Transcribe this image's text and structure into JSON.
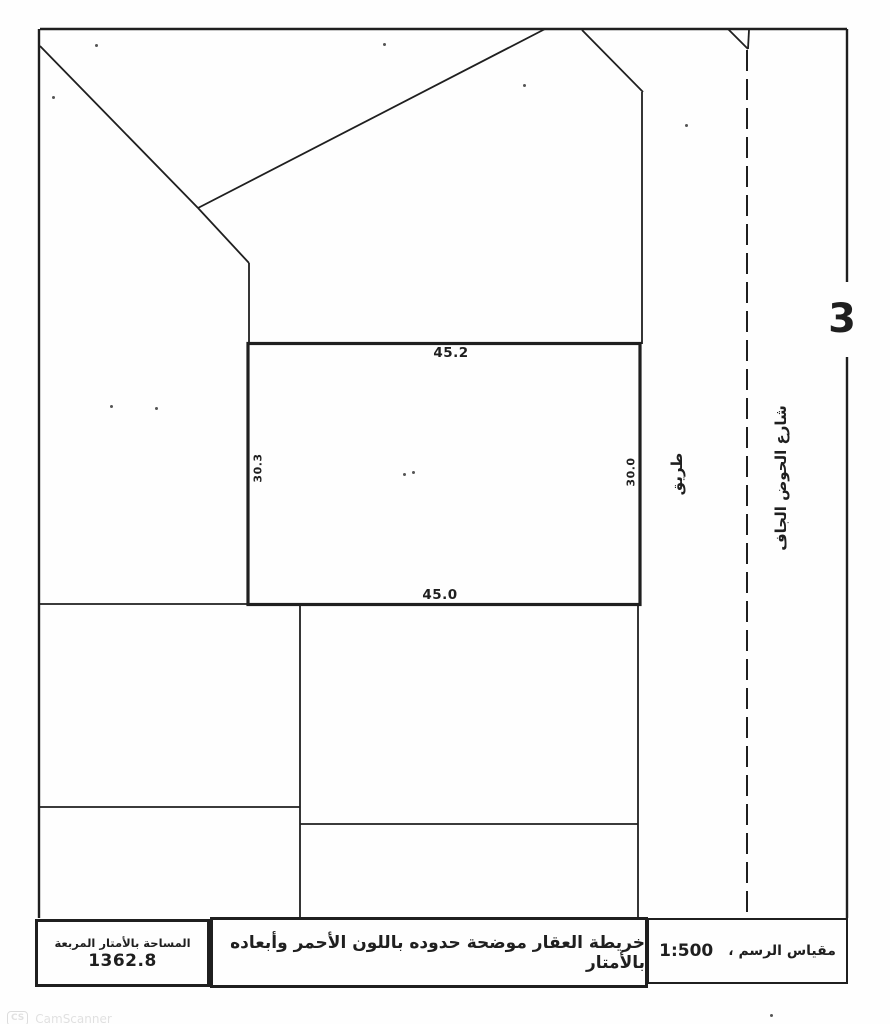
{
  "map": {
    "block_number": "3",
    "parcel": {
      "top": "45.2",
      "bottom": "45.0",
      "left": "30.3",
      "right": "30.0"
    },
    "labels": {
      "road": "طريق",
      "street": "شارع الحوض الجاف"
    }
  },
  "footer": {
    "area": {
      "header": "المساحة بالأمتار المربعة",
      "value": "1362.8"
    },
    "description": "خريطة العقار موضحة حدوده باللون الأحمر وأبعاده بالأمتار",
    "scale": {
      "label": "مقياس الرسم ،",
      "value": "1:500"
    }
  },
  "watermark": {
    "badge": "CS",
    "text": "CamScanner"
  },
  "colors": {
    "ink": "#1f1f1f",
    "paper": "#fefefe"
  }
}
